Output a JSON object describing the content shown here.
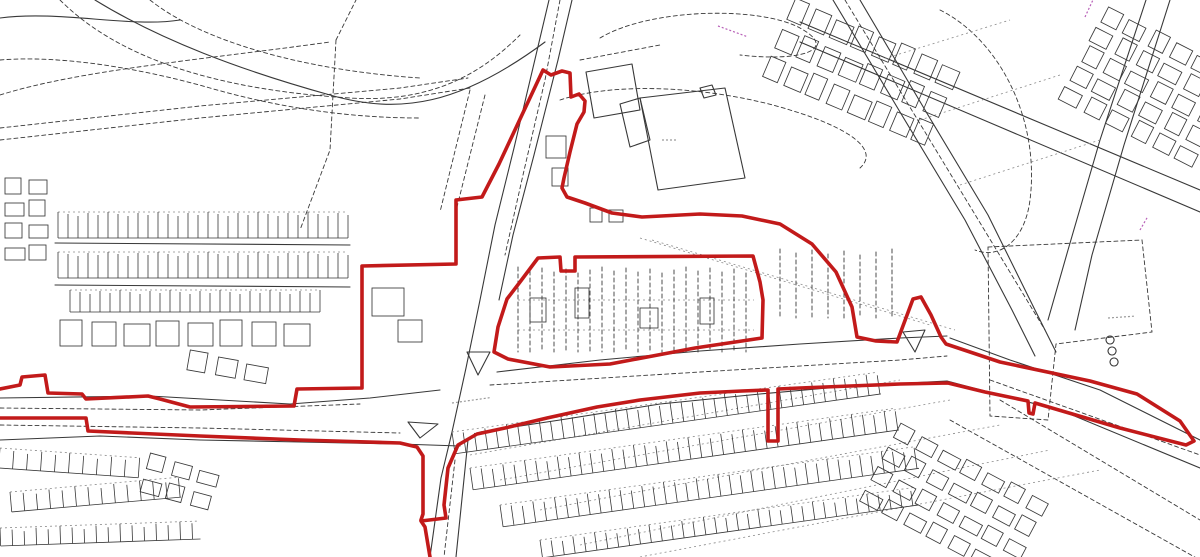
{
  "meta": {
    "title": "Site location plan with red line boundary",
    "width": 1200,
    "height": 557
  },
  "colors": {
    "background": "#ffffff",
    "map_line": "#383838",
    "map_line_faint": "#8a8a8a",
    "boundary_red": "#c21a1a",
    "magenta_label": "#b860b8",
    "road_label_gray": "#9a9a9a"
  },
  "boundary": {
    "stroke_width": 3.6,
    "paths": [
      "M0,389 L20,385 L22,377 L45,375 L48,393 L82,394 L86,399 L148,396 L160,399 L190,407 L294,406 L297,389 L362,388 L362,266 L456,264 L456,200 L482,197 L499,164 L543,70 L551,75 L562,71 L570,73 L571,97 L579,94 L585,101 L584,112 L577,124 L570,152 L564,178 L562,188 L567,197 L585,203 L612,213 L642,217 L700,214 L742,216 L780,224 L812,244 L836,272 L852,307 L857,337 L876,341 L897,342 L913,299 L921,297 L931,315 L941,337 L946,344 L1000,362 L1090,381 L1137,394 L1180,421 L1194,441 L1186,445 L1120,428 L1035,403 L1033,414 L1029,413 L1028,401 L985,392 L948,383 L900,384 L850,386 L800,388 L778,389 L778,441 L768,441 L768,390 L742,391 L700,393 L640,400 L597,407 L547,418 L505,428 L477,434 L458,445 L448,468 L444,505 L446,518 L421,521 L425,527 L430,557",
      "M0,418 L86,418 L88,431 L132,433 L200,436 L300,440 L400,443 L417,447 L423,456 L423,514 L421,520",
      "M538,258 L560,257 L561,271 L575,271 L575,257 L753,256 L760,282 L763,300 L762,338 L695,348 L610,364 L550,367 L508,359 L494,352 L498,327 L507,299 L520,282 Z"
    ]
  },
  "base_map": {
    "solid_paths": [
      "M549,0 L536,55 L514,148 L495,225 L480,300 L466,368 L452,432 L441,478 L430,557",
      "M572,0 L558,60 L534,155 L513,235 L499,300",
      "M468,440 L456,557",
      "M0,398 L150,396 L290,404 L370,398 L440,390",
      "M497,372 L600,360 L700,351 L800,344 L900,338 L947,336",
      "M0,440 L100,436 L200,440 L300,442 L400,444 L460,446",
      "M480,432 L560,420 L660,404 L760,394 L850,386 L947,381",
      "M950,338 L1010,360 L1100,390 L1200,440",
      "M947,381 L1000,395 L1060,410 L1200,468",
      "M833,0 L900,112 L965,220 L1012,310 L1035,356",
      "M860,0 L925,110 L988,215 L1035,310 L1056,352",
      "M1146,0 L1100,140 L1068,250 L1048,320",
      "M1170,0 L1124,145 L1092,255 L1075,330",
      "M800,22 L1200,190",
      "M800,42 L1200,212",
      "M95,0 C160,40 240,70 330,95 C400,115 460,105 545,42",
      "M0,18 C60,10 130,28 180,20",
      "M640,98 L725,88 L745,178 L658,190 Z",
      "M620,104 L640,98 L650,140 L630,147 Z",
      "M700,88 L712,85 L716,95 L704,98 Z",
      "M586,72 L632,64 L640,110 L594,118 Z",
      "M467,352 L490,352 L478,375 Z",
      "M408,422 L438,424 L420,438 Z",
      "M903,332 L925,330 L915,352 Z",
      "M55,243 L350,245",
      "M55,285 L350,287",
      "M1110,336 a4,4 0 1 0 0.1,0",
      "M1112,347 a4,4 0 1 0 0.1,0",
      "M1114,358 a4,4 0 1 0 0.1,0"
    ],
    "dashed_paths": [
      "M560,0 L545,80 L523,175 L505,255",
      "M455,460 L444,557",
      "M0,140 L200,118 L400,99 L470,88",
      "M0,128 L200,106 L400,88 L468,78",
      "M600,38 C650,8 760,6 800,28 C840,50 800,62 740,55",
      "M560,100 C620,80 720,88 790,110 C850,128 880,150 860,168",
      "M940,10 C1000,40 1040,120 1030,200 C1025,240 1000,260 975,250",
      "M0,95 C80,70 200,60 330,42",
      "M60,0 C120,60 220,90 350,98 C430,103 480,75 520,35",
      "M150,0 C200,40 300,70 420,78",
      "M0,60 C60,55 140,68 210,88 C280,108 350,118 420,118",
      "M470,90 L440,212",
      "M485,95 L455,215",
      "M336,40 L356,0",
      "M336,40 L330,150 L300,230",
      "M580,60 L660,45",
      "M988,247 L1142,240 L1152,332 L1056,344 L1048,420 L990,416 Z",
      "M845,0 L1045,330",
      "M950,420 L1200,560",
      "M1000,400 L1200,520",
      "M0,408 L200,410 L360,404",
      "M0,425 L200,428 L400,433",
      "M490,385 L700,372 L900,360 L947,356",
      "M990,380 L1200,455"
    ],
    "faint_dashed_paths": [
      "M470,455 L900,380",
      "M500,480 L950,400",
      "M540,510 L1000,425",
      "M580,545 L1050,450",
      "M640,557 L1100,470",
      "M880,60 L1010,20",
      "M920,120 L1060,75",
      "M960,185 L1100,140",
      "M640,238 L930,325",
      "M652,240 L955,330",
      "M518,300 L754,300",
      "M518,330 L754,330"
    ]
  },
  "textures": {
    "combs": [
      {
        "x": 58,
        "y": 212,
        "w": 290,
        "h": 26,
        "step": 10,
        "angle": 0
      },
      {
        "x": 58,
        "y": 252,
        "w": 290,
        "h": 26,
        "step": 10,
        "angle": 0
      },
      {
        "x": 70,
        "y": 290,
        "w": 250,
        "h": 22,
        "step": 10,
        "angle": 0
      },
      {
        "x": 452,
        "y": 432,
        "w": 430,
        "h": 22,
        "step": 11,
        "angle": -8
      },
      {
        "x": 470,
        "y": 468,
        "w": 430,
        "h": 22,
        "step": 11,
        "angle": -8
      },
      {
        "x": 500,
        "y": 505,
        "w": 420,
        "h": 22,
        "step": 11,
        "angle": -8
      },
      {
        "x": 540,
        "y": 540,
        "w": 380,
        "h": 18,
        "step": 11,
        "angle": -8
      },
      {
        "x": 0,
        "y": 448,
        "w": 140,
        "h": 20,
        "step": 14,
        "angle": 4
      },
      {
        "x": 10,
        "y": 492,
        "w": 170,
        "h": 20,
        "step": 13,
        "angle": -5
      },
      {
        "x": 0,
        "y": 528,
        "w": 200,
        "h": 18,
        "step": 12,
        "angle": -2
      }
    ],
    "grids": [
      {
        "x": 795,
        "y": 0,
        "cols": 8,
        "rows": 3,
        "cw": 17,
        "ch": 21,
        "gx": 6,
        "gy": 10,
        "angle": 23
      },
      {
        "x": 1060,
        "y": 100,
        "cols": 5,
        "rows": 6,
        "cw": 16,
        "ch": 18,
        "gx": 6,
        "gy": 8,
        "angle": -63
      },
      {
        "x": 900,
        "y": 425,
        "cols": 7,
        "rows": 4,
        "cw": 18,
        "ch": 14,
        "gx": 7,
        "gy": 10,
        "angle": 28
      },
      {
        "x": 60,
        "y": 322,
        "cols": 8,
        "rows": 1,
        "cw": 24,
        "ch": 24,
        "gx": 8,
        "gy": 6,
        "angle": 0
      },
      {
        "x": 190,
        "y": 352,
        "cols": 3,
        "rows": 1,
        "cw": 20,
        "ch": 18,
        "gx": 9,
        "gy": 6,
        "angle": 10
      },
      {
        "x": 5,
        "y": 180,
        "cols": 2,
        "rows": 4,
        "cw": 18,
        "ch": 14,
        "gx": 6,
        "gy": 8,
        "angle": 0
      },
      {
        "x": 150,
        "y": 455,
        "cols": 3,
        "rows": 2,
        "cw": 18,
        "ch": 14,
        "gx": 8,
        "gy": 10,
        "angle": 15
      },
      {
        "x": 372,
        "y": 290,
        "cols": 1,
        "rows": 1,
        "cw": 34,
        "ch": 26,
        "gx": 0,
        "gy": 0,
        "angle": 0
      },
      {
        "x": 398,
        "y": 322,
        "cols": 1,
        "rows": 1,
        "cw": 26,
        "ch": 20,
        "gx": 0,
        "gy": 0,
        "angle": 0
      },
      {
        "x": 530,
        "y": 300,
        "cols": 1,
        "rows": 1,
        "cw": 18,
        "ch": 22,
        "gx": 0,
        "gy": 0,
        "angle": 0
      },
      {
        "x": 575,
        "y": 290,
        "cols": 1,
        "rows": 1,
        "cw": 16,
        "ch": 28,
        "gx": 0,
        "gy": 0,
        "angle": 0
      },
      {
        "x": 640,
        "y": 310,
        "cols": 1,
        "rows": 1,
        "cw": 20,
        "ch": 18,
        "gx": 0,
        "gy": 0,
        "angle": 0
      },
      {
        "x": 700,
        "y": 300,
        "cols": 1,
        "rows": 1,
        "cw": 16,
        "ch": 24,
        "gx": 0,
        "gy": 0,
        "angle": 0
      },
      {
        "x": 546,
        "y": 138,
        "cols": 1,
        "rows": 1,
        "cw": 22,
        "ch": 20,
        "gx": 0,
        "gy": 0,
        "angle": 0
      },
      {
        "x": 552,
        "y": 170,
        "cols": 1,
        "rows": 1,
        "cw": 18,
        "ch": 16,
        "gx": 0,
        "gy": 0,
        "angle": 0
      },
      {
        "x": 590,
        "y": 210,
        "cols": 2,
        "rows": 1,
        "cw": 14,
        "ch": 12,
        "gx": 5,
        "gy": 4,
        "angle": 0
      }
    ],
    "vhatches": [
      {
        "x": 518,
        "y": 268,
        "w": 236,
        "h": 86,
        "step": 12
      },
      {
        "x": 780,
        "y": 250,
        "w": 120,
        "h": 70,
        "step": 16
      }
    ]
  },
  "label_marks": [
    {
      "x": 718,
      "y": 26,
      "len": 30,
      "angle": 20,
      "color": "#b860b8"
    },
    {
      "x": 1085,
      "y": 17,
      "len": 18,
      "angle": -65,
      "color": "#b860b8"
    },
    {
      "x": 1140,
      "y": 230,
      "len": 14,
      "angle": -60,
      "color": "#b860b8"
    },
    {
      "x": 452,
      "y": 403,
      "len": 40,
      "angle": -8,
      "color": "#9a9a9a"
    },
    {
      "x": 1108,
      "y": 318,
      "len": 26,
      "angle": -4,
      "color": "#9a9a9a"
    },
    {
      "x": 662,
      "y": 140,
      "len": 16,
      "angle": 0,
      "color": "#9a9a9a"
    }
  ]
}
